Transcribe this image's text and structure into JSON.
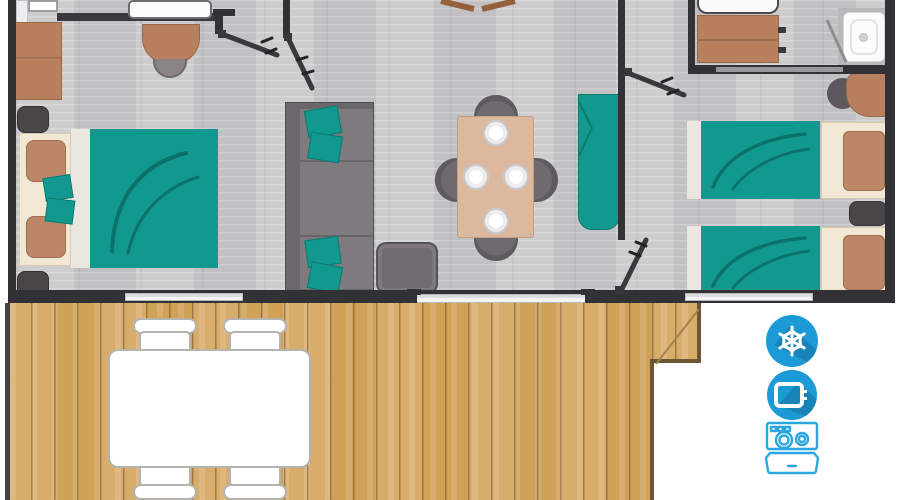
{
  "page": {
    "kind": "mobile-home floor plan render",
    "background": "#ffffff"
  },
  "palette": {
    "bg": "#ffffff",
    "wall": "#323136",
    "floor": "#c7c7c9",
    "teal": "#12998f",
    "teal_dark": "#0c7168",
    "wood_light": "#d8ad6b",
    "wood_mid": "#cfa258",
    "wood_edge": "#6b5635",
    "furniture_brown": "#b8805f",
    "cream": "#f0e8d2",
    "pillow_brown": "#bd8668",
    "sofa_gray": "#6b666b",
    "sofa_seat": "#7f7a7d",
    "chair_gray": "#6f6a6d",
    "chair_seat": "#b3afb1",
    "table_beige": "#dcb99e",
    "stool_gray": "#8b8486",
    "icon_blue": "#1b9ad6",
    "icon_blue_shadow": "#14719f",
    "icon_outline_blue": "#2aa7e0"
  },
  "rooms": [
    {
      "name": "double-bedroom"
    },
    {
      "name": "living-dining-area"
    },
    {
      "name": "hallway"
    },
    {
      "name": "bathroom"
    },
    {
      "name": "twin-bedroom"
    },
    {
      "name": "wooden-terrace"
    }
  ],
  "amenities": [
    {
      "name": "air-conditioning",
      "glyph": "snowflake"
    },
    {
      "name": "television",
      "glyph": "tv-screen"
    },
    {
      "name": "dishwasher",
      "glyph": "dishwasher-open-door"
    }
  ]
}
